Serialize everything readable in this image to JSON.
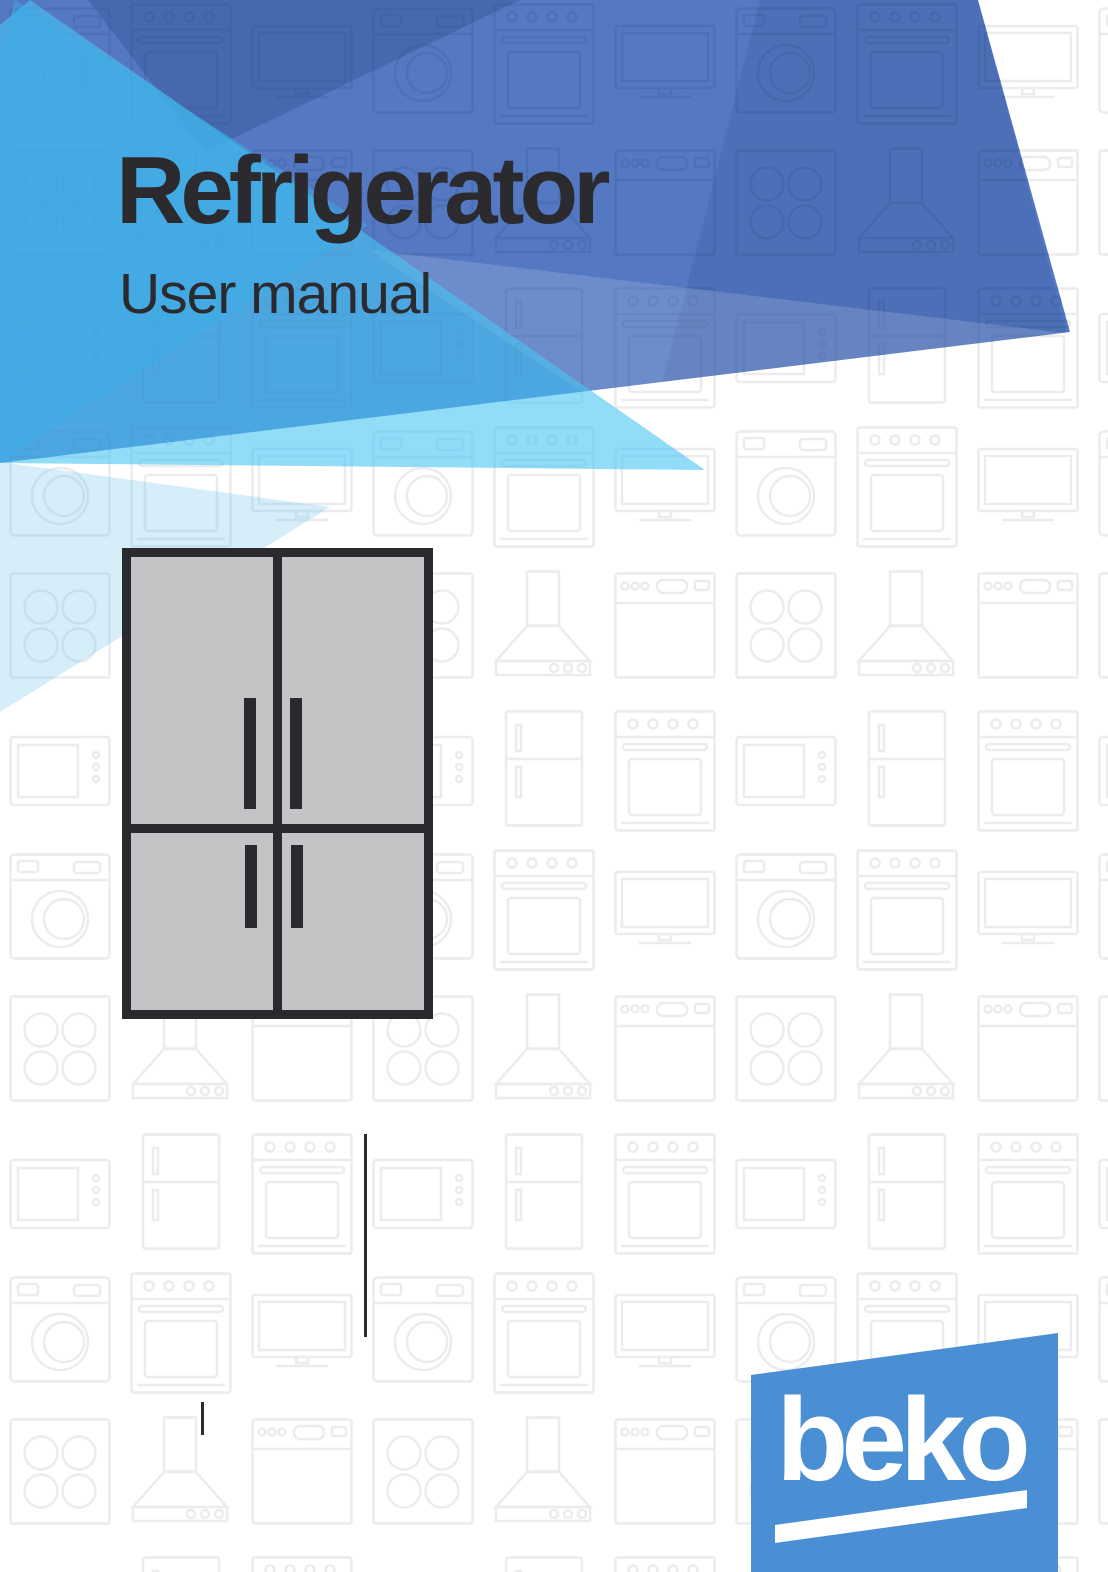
{
  "cover": {
    "title": "Refrigerator",
    "subtitle": "User manual"
  },
  "brand": {
    "logo_text": "beko"
  },
  "illustration": {
    "label": "four-door-refrigerator"
  },
  "pattern_icons": [
    "washing-machine",
    "oven",
    "tv",
    "cooktop",
    "range-hood",
    "dishwasher",
    "microwave",
    "refrigerator"
  ],
  "palette": {
    "banner_blue": "#5478c2",
    "cyan_accent": "#48c4f2",
    "light_cyan": "#aed8f0",
    "pale_cyan": "#d8ecf8",
    "logo_blue": "#4a8fd4",
    "text_dark": "#2b2a2f",
    "fridge_gray": "#c4c3c5",
    "outline_dark": "#2a292e",
    "pattern_gray": "#ececef",
    "pattern_blue": "#4c70b6"
  }
}
